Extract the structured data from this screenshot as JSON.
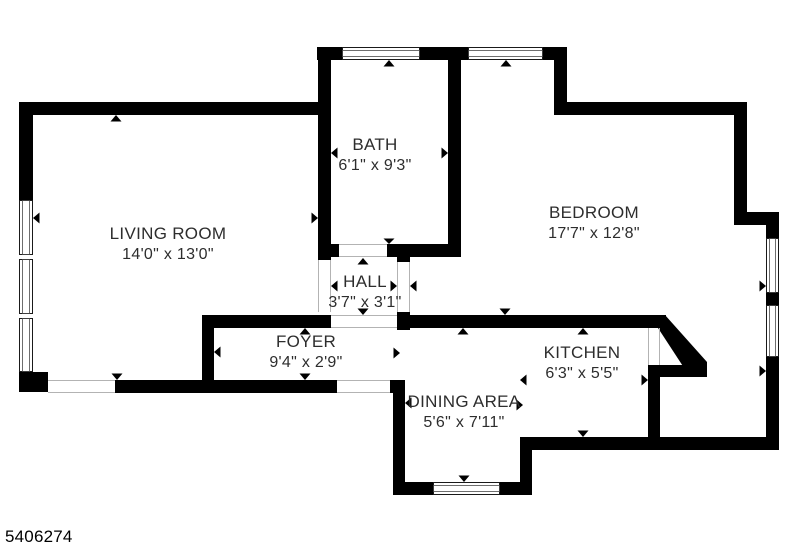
{
  "plan_id": "5406274",
  "rooms": [
    {
      "id": "living-room",
      "name": "LIVING ROOM",
      "dims": "14'0\" x 13'0\""
    },
    {
      "id": "bath",
      "name": "BATH",
      "dims": "6'1\" x 9'3\""
    },
    {
      "id": "bedroom",
      "name": "BEDROOM",
      "dims": "17'7\" x 12'8\""
    },
    {
      "id": "hall",
      "name": "HALL",
      "dims": "3'7\" x 3'1\""
    },
    {
      "id": "foyer",
      "name": "FOYER",
      "dims": "9'4\" x 2'9\""
    },
    {
      "id": "kitchen",
      "name": "KITCHEN",
      "dims": "6'3\" x 5'5\""
    },
    {
      "id": "dining-area",
      "name": "DINING AREA",
      "dims": "5'6\" x 7'11\""
    }
  ],
  "colors": {
    "wall": "#000000",
    "text": "#2d2d2d",
    "background": "#ffffff",
    "threshold": "#b3b3b3"
  }
}
